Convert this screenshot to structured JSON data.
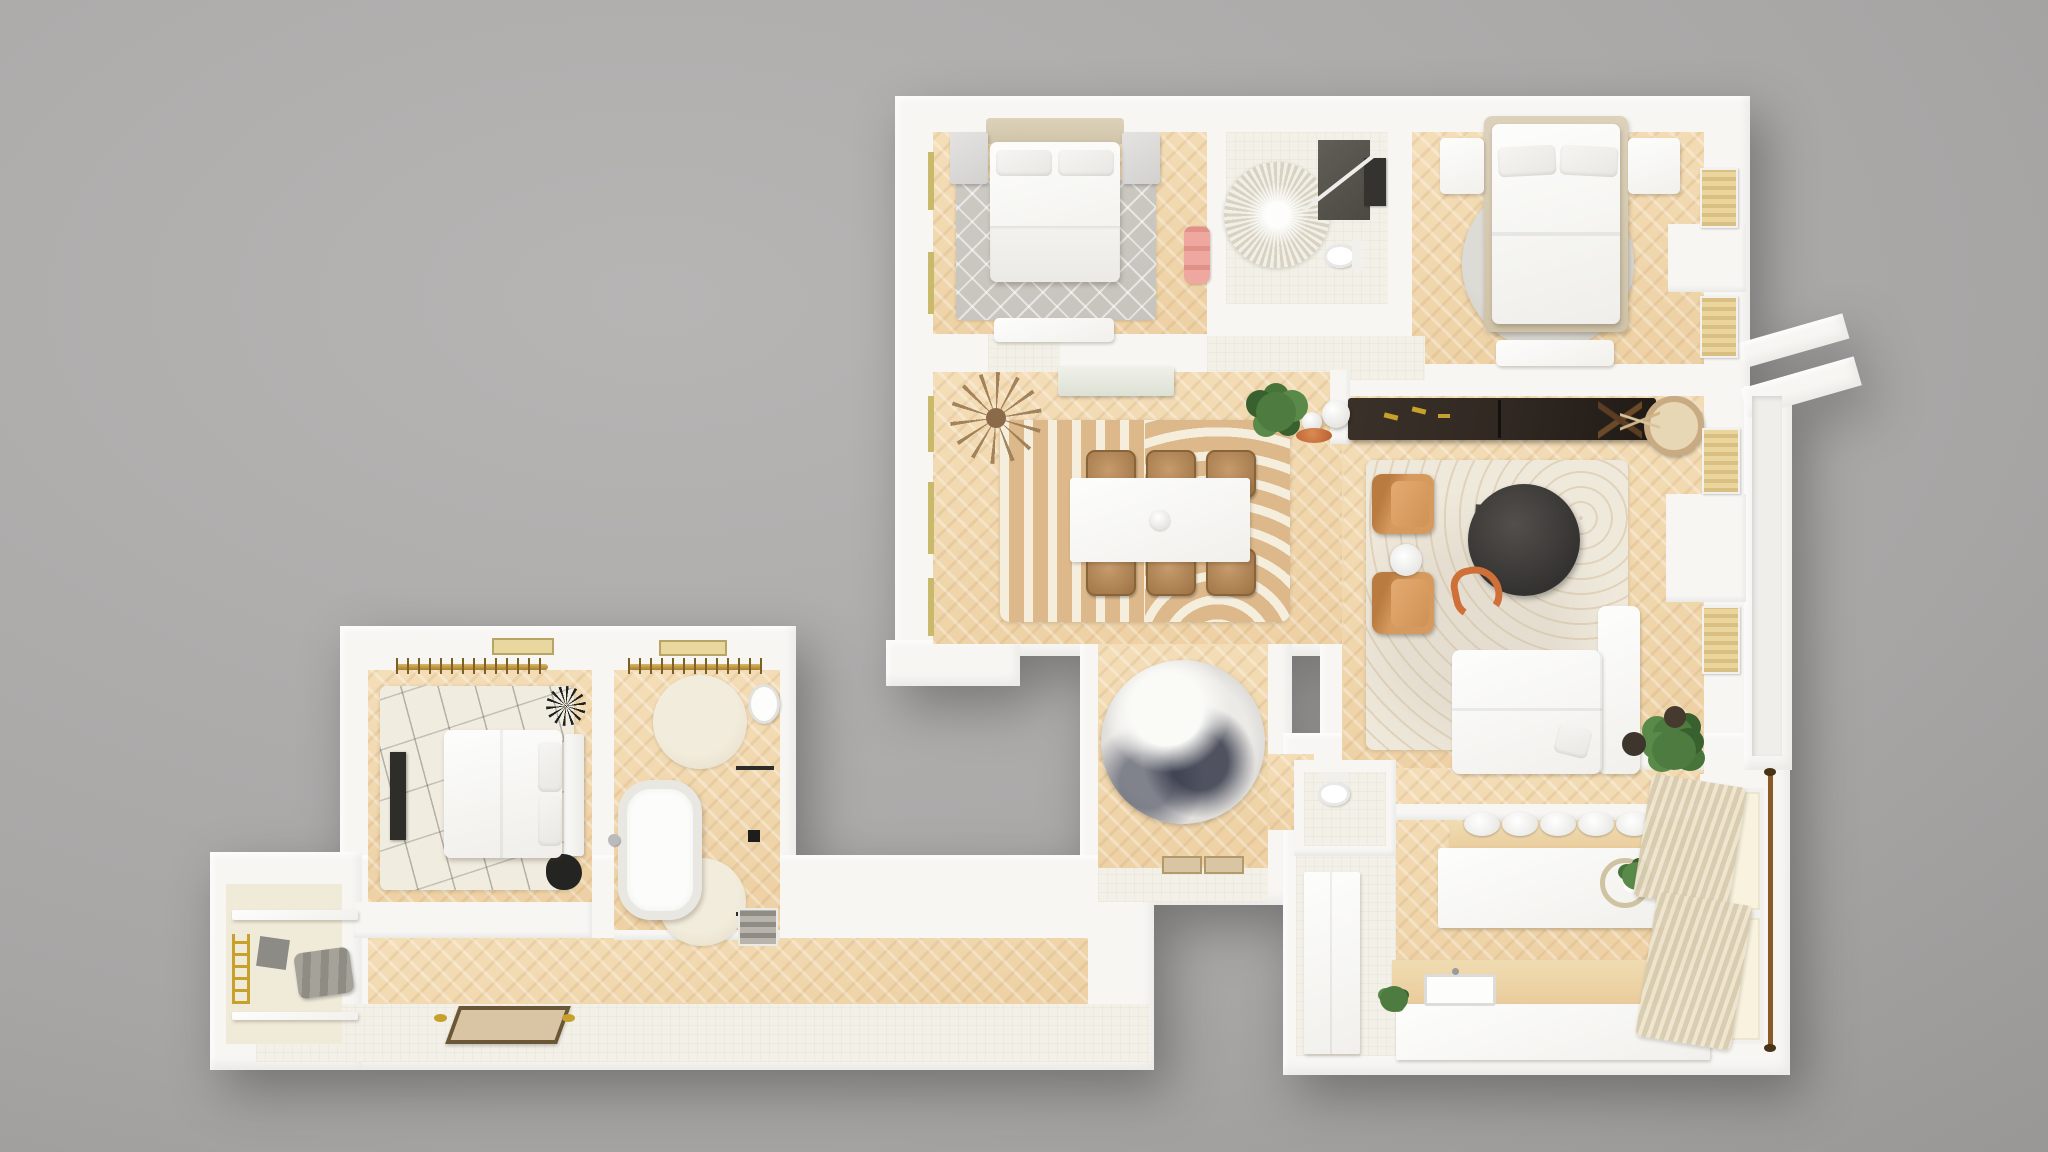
{
  "title": "3D apartment floor plan render — top-down view",
  "render_type": "photoreal 3d floorplan, no visible text or UI controls",
  "colors": {
    "background": "#b7b5b4",
    "wall": "#f7f6f3",
    "wood_light": "#f4deb8",
    "wood_dark": "#edd0a3",
    "tile": "#f3f0e7",
    "cream_floor": "#f0ead9",
    "rug_gray": "#c7c4be",
    "rug_cream": "#efe9dc",
    "rug_tan": "#dcb88b",
    "rug_stripe": "#f6eedd",
    "leather": "#d6995e",
    "leather_dark": "#b97b3f",
    "table_black": "#403f3d",
    "sideboard_dark": "#2f2721",
    "gold": "#c7a12b",
    "plant_green": "#4e7c40",
    "plant_dark_green": "#39602f",
    "towel_pink": "#efa8a0",
    "curtain": "#d8ccb0",
    "window_glass": "#c9b96a",
    "marble_rug_dark": "#3f434f",
    "doormat_tan": "#d9c4a4",
    "counter_wood": "#e9cb9b",
    "accent_orange": "#cf7038"
  },
  "rooms": [
    {
      "id": "bedroom-1",
      "position": "top-left",
      "furniture": [
        "double-bed",
        "two-nightstands",
        "diamond-pattern-rug",
        "foot-bench",
        "pink-towel-rack",
        "two-west-windows"
      ]
    },
    {
      "id": "bathroom-1",
      "position": "top-middle",
      "furniture": [
        "round-starburst-rug",
        "dark-shower",
        "dark-vanity",
        "toilet"
      ]
    },
    {
      "id": "bedroom-2",
      "position": "top-right",
      "furniture": [
        "double-bed-beige-frame",
        "two-nightstands",
        "round-gray-rug",
        "foot-bench",
        "two-east-windows-with-radiators"
      ]
    },
    {
      "id": "dining-room",
      "position": "center-left",
      "furniture": [
        "white-dining-table",
        "six-wood-chairs",
        "striped-arc-rug",
        "dried-star-plant",
        "green-plant",
        "white-console",
        "three-west-windows",
        "south-balcony"
      ]
    },
    {
      "id": "living-room",
      "position": "center-right",
      "furniture": [
        "dark-sideboard-gold-handles",
        "sphere-lamps",
        "orange-bowl",
        "pampas-basket",
        "folding-stool",
        "cream-arc-rug",
        "two-leather-armchairs",
        "round-side-table",
        "black-round-coffee-table",
        "orange-squiggle-decor",
        "white-l-sofa",
        "corner-plant",
        "two-east-windows-with-radiators",
        "east-balcony",
        "roof-awnings"
      ]
    },
    {
      "id": "foyer",
      "position": "center",
      "furniture": [
        "round-marble-rug",
        "door-thresholds"
      ]
    },
    {
      "id": "kitchen",
      "position": "bottom-right",
      "furniture": [
        "island-with-wood-bar",
        "five-bar-stools",
        "flower-arrangement",
        "south-counter-with-sink",
        "tall-cabinet",
        "wc-room-with-toilet",
        "two-curtained-windows",
        "curtain-rod",
        "fiddle-leaf-plant"
      ]
    },
    {
      "id": "bedroom-3",
      "position": "bottom-left",
      "furniture": [
        "rotated-bed",
        "line-pattern-rug",
        "wall-tv",
        "dark-decor-plants",
        "clothes-rail-with-hangers"
      ]
    },
    {
      "id": "dressing-bath",
      "position": "bottom-left",
      "furniture": [
        "freestanding-oval-tub",
        "two-round-cream-rugs",
        "clothes-rail-with-hangers",
        "mirror-shower-panel",
        "sink",
        "shoe-shelf"
      ]
    },
    {
      "id": "closet",
      "position": "bottom-left-end",
      "furniture": [
        "shelves",
        "folded-blankets",
        "gold-ladder",
        "storage-panel"
      ]
    },
    {
      "id": "hallway-entry",
      "position": "bottom",
      "furniture": [
        "herringbone-hall-floor",
        "white-entry-tiles",
        "doormat",
        "gold-slippers"
      ]
    }
  ],
  "counts": {
    "dining_chairs": 6,
    "bar_stools": 5,
    "bedrooms": 3,
    "balconies": 2
  }
}
